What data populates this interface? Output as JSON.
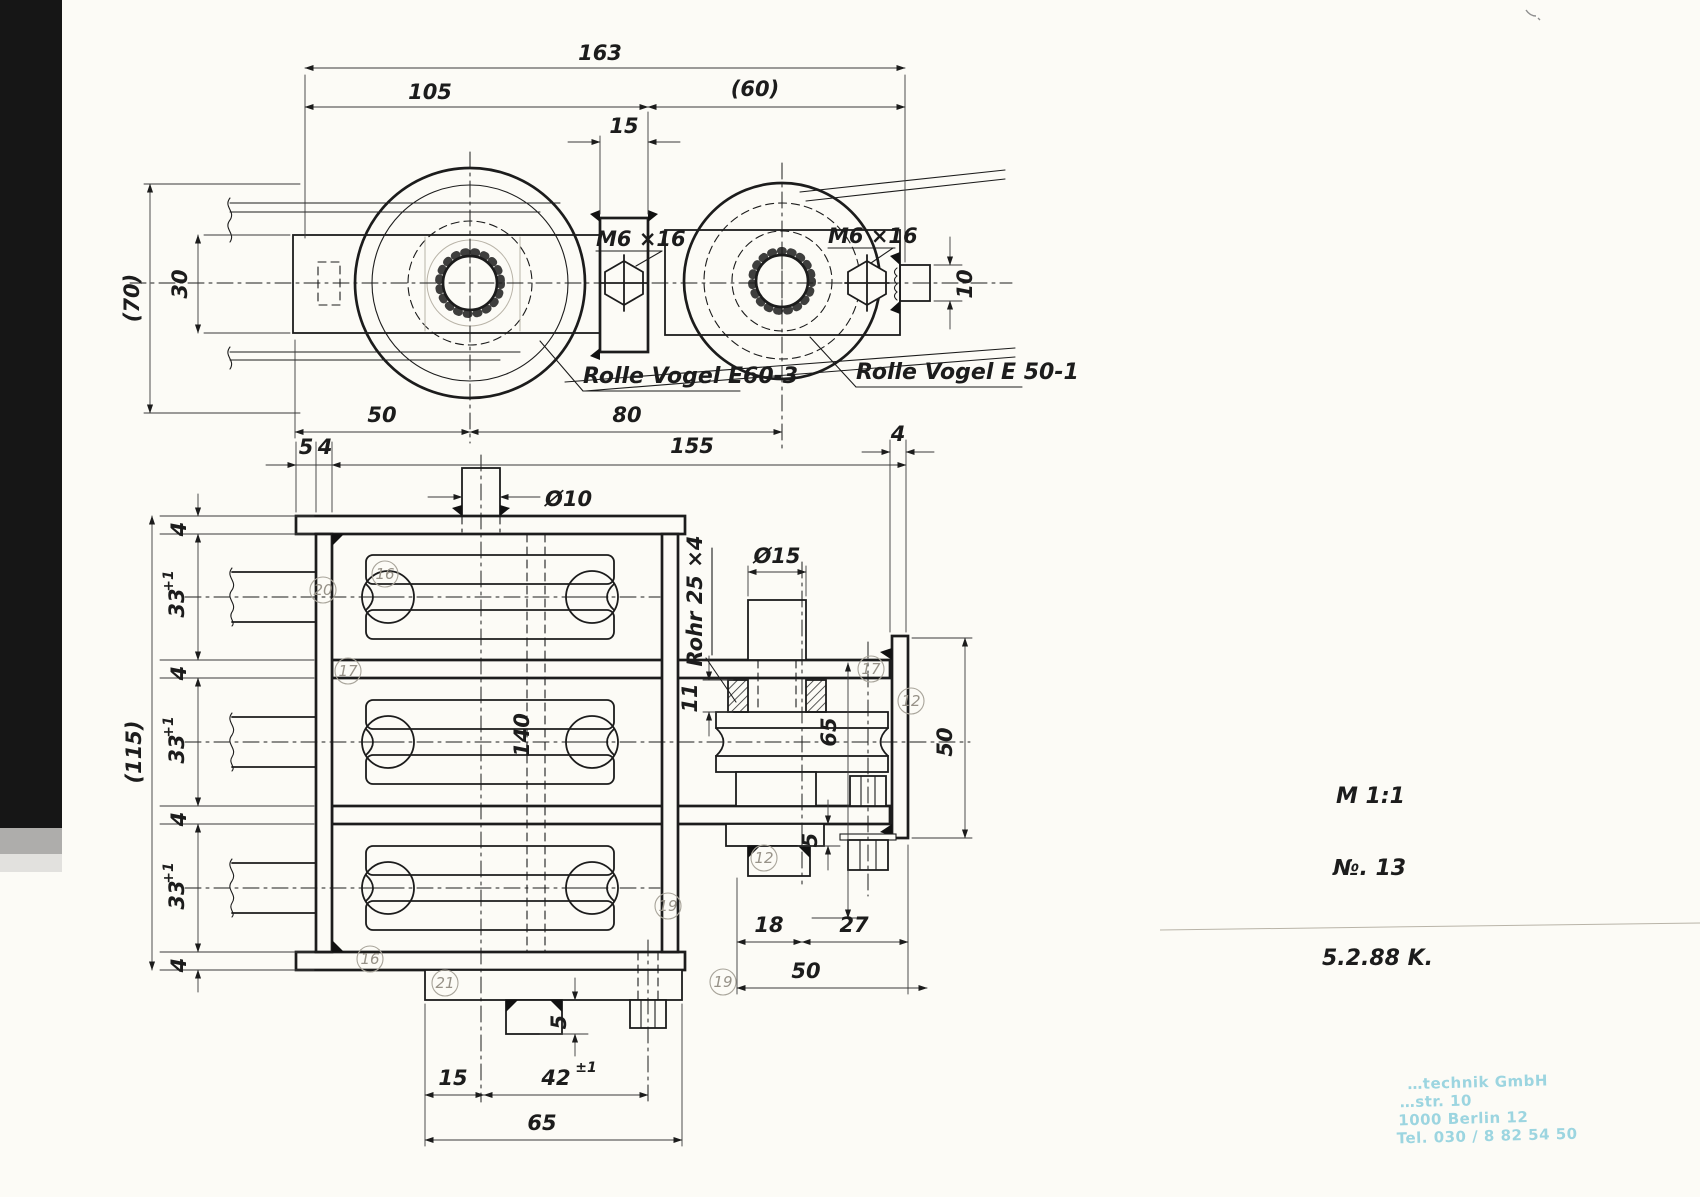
{
  "meta": {
    "scale": "M 1:1",
    "sheet_no": "№. 13",
    "date": "5.2.88 K."
  },
  "labels": {
    "roller_left": "Rolle Vogel E60-3",
    "roller_right": "Rolle Vogel E 50-1",
    "bolt_left": "M6 ×16",
    "bolt_right": "M6 ×16",
    "tube": "Rohr 25 ×4",
    "axle": "140"
  },
  "top_view": {
    "dims": {
      "overall": "163",
      "left_span": "105",
      "right_span": "(60)",
      "block": "15",
      "height": "(70)",
      "bar": "30",
      "stub": "10",
      "to_axis": "50",
      "axis_to_axis": "80"
    }
  },
  "front_view": {
    "dims": {
      "flange_l": "5",
      "wall_l": "4",
      "overall_w": "155",
      "plate_r": "4",
      "stub_dia": "Ø10",
      "overall_h": "(115)",
      "gap": "33",
      "gap_tol": "+1",
      "plate": "4",
      "sheave_dia": "Ø15",
      "bush_h": "11",
      "arm_h": "65",
      "plate_h": "50",
      "step": "5",
      "a": "18",
      "b": "27",
      "c": "50",
      "e": "15",
      "f": "42",
      "f_tol": "±1",
      "g": "65",
      "h": "5"
    }
  },
  "parts": {
    "p16_top": "16",
    "p20": "20",
    "p17_left": "17",
    "p19_body": "19",
    "p17_arm": "17",
    "p12_plate": "12",
    "p12_bracket": "12",
    "p19_low": "19",
    "p16_bottom": "16",
    "p21": "21"
  },
  "stamp": {
    "line1": "…technik GmbH",
    "line2": "…str. 10",
    "line3": "1000 Berlin 12",
    "line4": "Tel. 030 / 8 82 54 50"
  }
}
